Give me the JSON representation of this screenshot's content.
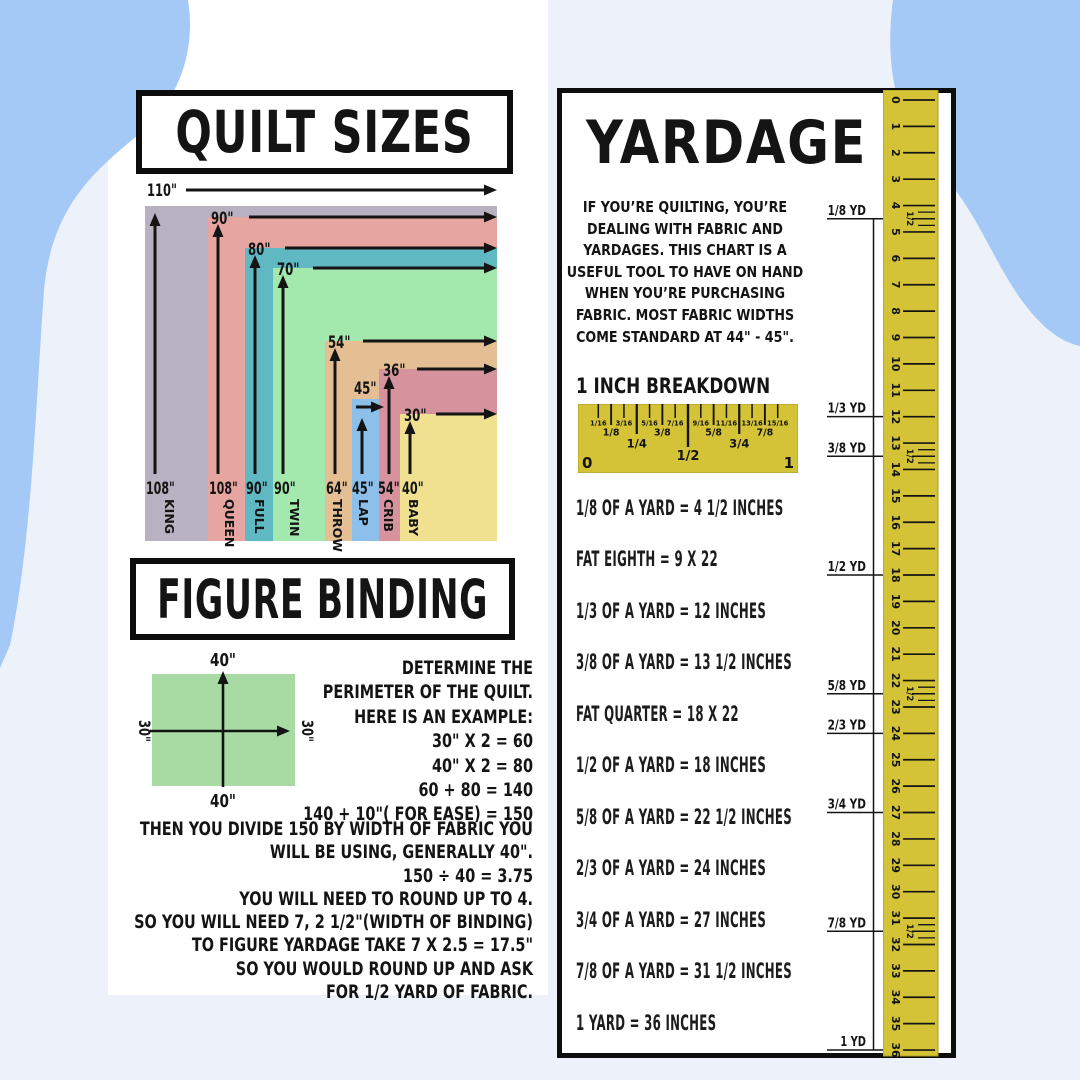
{
  "page": {
    "bg": "#edf1fa",
    "blob_color": "#a4c9f6",
    "card_color": "#ffffff",
    "ink": "#141414"
  },
  "quilt_panel": {
    "title": "QUILT SIZES"
  },
  "quilt_chart": {
    "right": 497,
    "bottom": 541,
    "items": [
      {
        "name": "KING",
        "height": "108\"",
        "width": "110\"",
        "color": "#b7b1c1",
        "left": 145,
        "top": 206,
        "wl_x": 147,
        "wl_y": 196,
        "a_x1": 186,
        "a_y": 190,
        "a_x2": 497,
        "v_x": 155,
        "num_x": 146,
        "name_cx": 171
      },
      {
        "name": "QUEEN",
        "height": "108\"",
        "width": "90\"",
        "color": "#e6a5a0",
        "left": 208,
        "top": 217,
        "wl_x": 211,
        "wl_y": 224,
        "a_x1": 249,
        "a_y": 217,
        "a_x2": 497,
        "v_x": 218,
        "num_x": 209,
        "name_cx": 231
      },
      {
        "name": "FULL",
        "height": "90\"",
        "width": "80\"",
        "color": "#5fb8c2",
        "left": 245,
        "top": 248,
        "wl_x": 248,
        "wl_y": 255,
        "a_x1": 285,
        "a_y": 248,
        "a_x2": 497,
        "v_x": 255,
        "num_x": 246,
        "name_cx": 261
      },
      {
        "name": "TWIN",
        "height": "90\"",
        "width": "70\"",
        "color": "#a3e8ac",
        "left": 273,
        "top": 268,
        "wl_x": 277,
        "wl_y": 275,
        "a_x1": 313,
        "a_y": 268,
        "a_x2": 497,
        "v_x": 283,
        "num_x": 274,
        "name_cx": 296
      },
      {
        "name": "THROW",
        "height": "64\"",
        "width": "54\"",
        "color": "#e5bf94",
        "left": 325,
        "top": 341,
        "wl_x": 328,
        "wl_y": 348,
        "a_x1": 363,
        "a_y": 341,
        "a_x2": 497,
        "v_x": 335,
        "num_x": 326,
        "name_cx": 339
      },
      {
        "name": "LAP",
        "height": "45\"",
        "width": "45\"",
        "color": "#8cbfea",
        "left": 352,
        "top": 399,
        "wl_x": 354,
        "wl_y": 394,
        "a_x1": 356,
        "a_y": 407,
        "a_x2": 384,
        "v_x": 362,
        "v_top": 418,
        "num_x": 352,
        "name_cx": 365
      },
      {
        "name": "CRIB",
        "height": "54\"",
        "width": "36\"",
        "color": "#d6939e",
        "left": 379,
        "top": 369,
        "wl_x": 383,
        "wl_y": 376,
        "a_x1": 417,
        "a_y": 369,
        "a_x2": 497,
        "v_x": 389,
        "num_x": 378,
        "name_cx": 390
      },
      {
        "name": "BABY",
        "height": "40\"",
        "width": "30\"",
        "color": "#efe190",
        "left": 400,
        "top": 414,
        "wl_x": 404,
        "wl_y": 421,
        "a_x1": 436,
        "a_y": 414,
        "a_x2": 497,
        "v_x": 410,
        "num_x": 402,
        "name_cx": 415
      }
    ]
  },
  "binding_panel": {
    "title": "FIGURE BINDING",
    "diagram": {
      "fill": "#a8dba3",
      "top_label": "40\"",
      "bottom_label": "40\"",
      "left_label": "30\"",
      "right_label": "30\""
    },
    "lines_a": [
      "DETERMINE THE",
      "PERIMETER OF THE QUILT.",
      "HERE IS AN EXAMPLE:",
      "30\" X 2 = 60",
      "40\" X 2 = 80",
      "60 + 80 = 140",
      "140 + 10\"( FOR EASE) = 150"
    ],
    "lines_b": [
      "THEN YOU DIVIDE 150 BY WIDTH OF FABRIC YOU",
      "WILL BE USING, GENERALLY 40\".",
      "150 ÷ 40 = 3.75",
      "YOU WILL NEED TO ROUND UP TO 4.",
      "SO YOU WILL NEED 7, 2 1/2\"(WIDTH OF BINDING)",
      "TO FIGURE YARDAGE TAKE 7 X 2.5 = 17.5\"",
      "SO YOU WOULD ROUND UP AND ASK",
      "FOR 1/2 YARD OF FABRIC."
    ]
  },
  "yardage_panel": {
    "title": "YARDAGE",
    "intro_lines": [
      "IF YOU’RE QUILTING, YOU’RE",
      "DEALING WITH FABRIC AND",
      "YARDAGES. THIS CHART IS A",
      "USEFUL TOOL TO HAVE ON HAND",
      "WHEN YOU’RE PURCHASING",
      "FABRIC.  MOST FABRIC WIDTHS",
      "COME STANDARD AT 44\" - 45\"."
    ],
    "breakdown_heading": "1 INCH BREAKDOWN",
    "inch_ruler": {
      "fill": "#d4c337",
      "edge": "#a89b25",
      "end_labels": [
        "0",
        "1"
      ],
      "ticks": [
        {
          "f": 0.0625,
          "label": "1/16",
          "tier": 4
        },
        {
          "f": 0.125,
          "label": "1/8",
          "tier": 3
        },
        {
          "f": 0.1875,
          "label": "3/16",
          "tier": 4
        },
        {
          "f": 0.25,
          "label": "1/4",
          "tier": 2
        },
        {
          "f": 0.3125,
          "label": "5/16",
          "tier": 4
        },
        {
          "f": 0.375,
          "label": "3/8",
          "tier": 3
        },
        {
          "f": 0.4375,
          "label": "7/16",
          "tier": 4
        },
        {
          "f": 0.5,
          "label": "1/2",
          "tier": 1
        },
        {
          "f": 0.5625,
          "label": "9/16",
          "tier": 4
        },
        {
          "f": 0.625,
          "label": "5/8",
          "tier": 3
        },
        {
          "f": 0.6875,
          "label": "11/16",
          "tier": 4
        },
        {
          "f": 0.75,
          "label": "3/4",
          "tier": 2
        },
        {
          "f": 0.8125,
          "label": "13/16",
          "tier": 4
        },
        {
          "f": 0.875,
          "label": "7/8",
          "tier": 3
        },
        {
          "f": 0.9375,
          "label": "15/16",
          "tier": 4
        }
      ]
    },
    "conversions": [
      "1/8 OF A YARD = 4 1/2 INCHES",
      "FAT EIGHTH =  9 X 22",
      "1/3 OF A YARD = 12 INCHES",
      "3/8 OF A YARD = 13 1/2 INCHES",
      "FAT QUARTER = 18 X 22",
      "1/2 OF A YARD = 18 INCHES",
      "5/8 OF A YARD = 22 1/2 INCHES",
      "2/3 OF A YARD = 24 INCHES",
      "3/4 OF A YARD = 27 INCHES",
      "7/8 OF A YARD = 31 1/2 INCHES",
      "1 YARD = 36 INCHES"
    ],
    "vruler": {
      "fill": "#d4c337",
      "edge": "#a89b25",
      "min": 0,
      "max": 36,
      "special_inches": [
        4,
        13,
        22,
        31
      ],
      "half_label": "1/2"
    },
    "yard_markers": [
      {
        "label": "1/8 YD",
        "inches": 4.5
      },
      {
        "label": "1/3 YD",
        "inches": 12
      },
      {
        "label": "3/8 YD",
        "inches": 13.5
      },
      {
        "label": "1/2 YD",
        "inches": 18
      },
      {
        "label": "5/8 YD",
        "inches": 22.5
      },
      {
        "label": "2/3 YD",
        "inches": 24
      },
      {
        "label": "3/4 YD",
        "inches": 27
      },
      {
        "label": "7/8 YD",
        "inches": 31.5
      },
      {
        "label": "1 YD",
        "inches": 36
      }
    ]
  },
  "chart_data": [
    {
      "type": "table",
      "title": "QUILT SIZES",
      "columns": [
        "quilt",
        "width_inches",
        "height_inches"
      ],
      "rows": [
        [
          "KING",
          110,
          108
        ],
        [
          "QUEEN",
          90,
          108
        ],
        [
          "FULL",
          80,
          90
        ],
        [
          "TWIN",
          70,
          90
        ],
        [
          "THROW",
          54,
          64
        ],
        [
          "LAP",
          45,
          45
        ],
        [
          "CRIB",
          36,
          54
        ],
        [
          "BABY",
          30,
          40
        ]
      ]
    },
    {
      "type": "table",
      "title": "YARDAGE",
      "columns": [
        "fraction_of_yard",
        "inches"
      ],
      "rows": [
        [
          "1/8 YD",
          4.5
        ],
        [
          "1/3 YD",
          12
        ],
        [
          "3/8 YD",
          13.5
        ],
        [
          "1/2 YD",
          18
        ],
        [
          "5/8 YD",
          22.5
        ],
        [
          "2/3 YD",
          24
        ],
        [
          "3/4 YD",
          27
        ],
        [
          "7/8 YD",
          31.5
        ],
        [
          "1 YD",
          36
        ]
      ]
    }
  ]
}
